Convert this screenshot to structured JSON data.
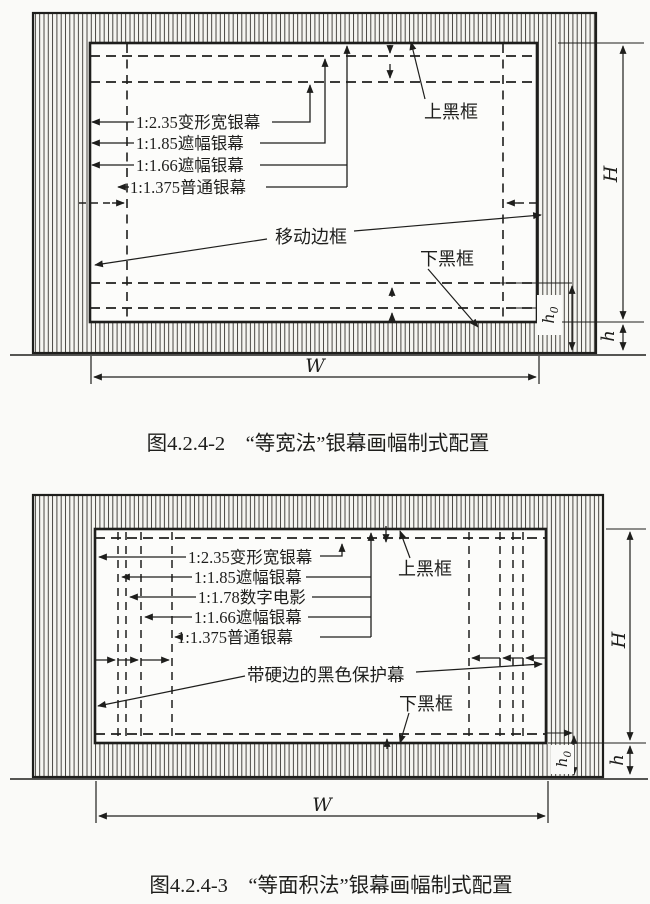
{
  "page": {
    "paper_color": "#fafaf8",
    "ink_color": "#1e1e1c"
  },
  "fig_equal_width": {
    "caption": "图4.2.4-2　“等宽法”银幕画幅制式配置",
    "formats": [
      "1:2.35变形宽银幕",
      "1:1.85遮幅银幕",
      "1:1.66遮幅银幕",
      "1:1.375普通银幕"
    ],
    "top_black_frame": "上黑框",
    "bottom_black_frame": "下黑框",
    "movable_edge": "移动边框",
    "dims": {
      "W": "W",
      "H": "H",
      "h": "h",
      "h0_main": "h",
      "h0_sub": "0"
    }
  },
  "fig_equal_area": {
    "caption": "图4.2.4-3　“等面积法”银幕画幅制式配置",
    "formats": [
      "1:2.35变形宽银幕",
      "1:1.85遮幅银幕",
      "1:1.78数字电影",
      "1:1.66遮幅银幕",
      "1:1.375普通银幕"
    ],
    "top_black_frame": "上黑框",
    "bottom_black_frame": "下黑框",
    "protective_screen": "带硬边的黑色保护幕",
    "dims": {
      "W": "W",
      "H": "H",
      "h": "h",
      "h0_main": "h",
      "h0_sub": "0"
    }
  }
}
